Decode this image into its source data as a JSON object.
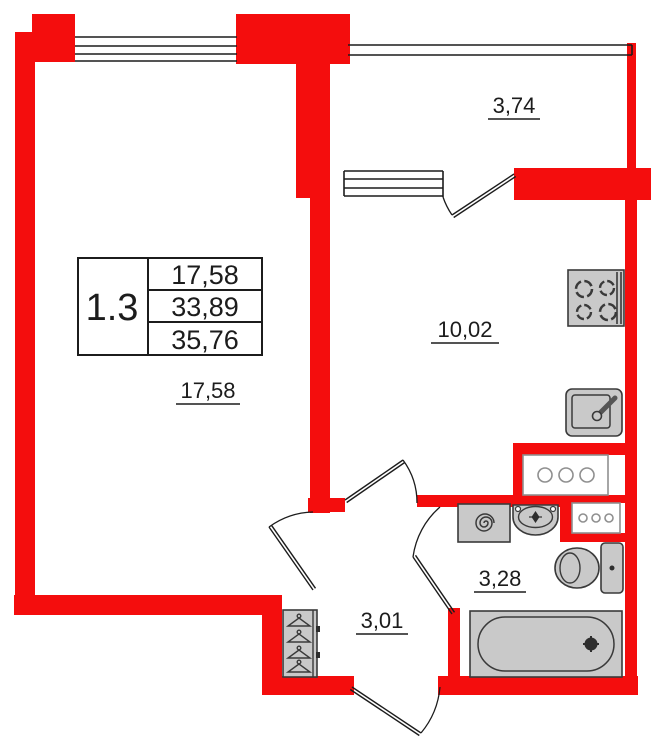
{
  "floorplan": {
    "unit": {
      "number": "1.3",
      "living_area": "17,58",
      "area": "33,89",
      "total_area": "35,76"
    },
    "rooms": {
      "balcony": {
        "area": "3,74"
      },
      "kitchen": {
        "area": "10,02"
      },
      "living_room": {
        "area": "17,58"
      },
      "hallway": {
        "area": "3,01"
      },
      "bathroom": {
        "area": "3,28"
      }
    },
    "colors": {
      "wall": "#f40d0d",
      "fixture": "#c9c9c9",
      "line": "#1c1c1c"
    }
  }
}
